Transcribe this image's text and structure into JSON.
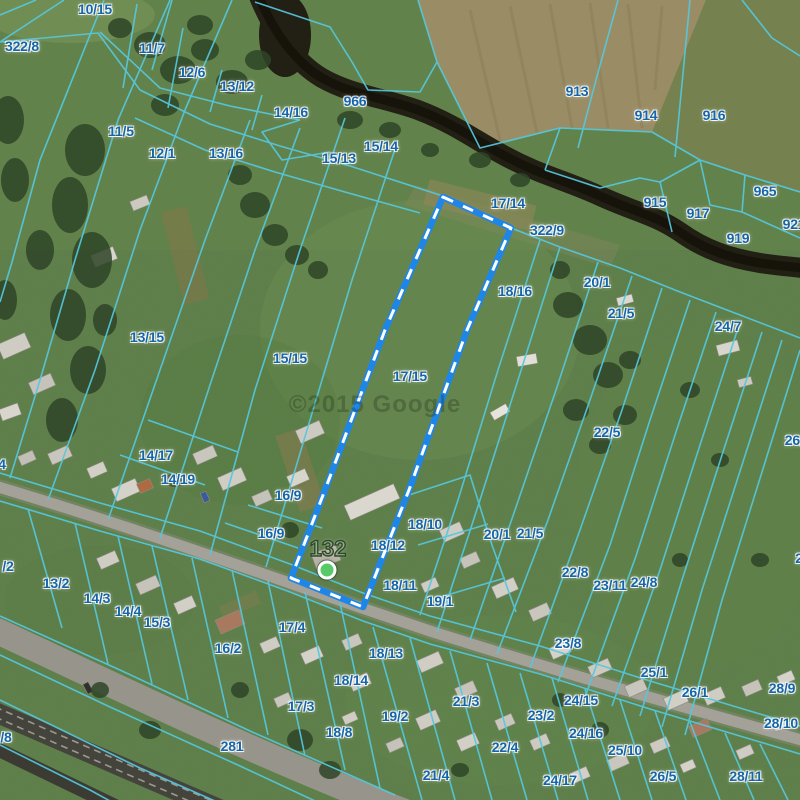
{
  "map": {
    "watermark": "©2015 Google",
    "selection": {
      "parcel_number": "17/15",
      "style": "blue-white-dashed"
    },
    "marker": {
      "label": "132",
      "x": 327,
      "y": 570
    },
    "colors": {
      "parcel_line": "#55c8de",
      "label_text": "#1565a8",
      "selection_stroke": "#1d86e8",
      "selection_dash": "#ffffff",
      "marker_fill": "#57c967",
      "marker_label": "#95aa8d"
    },
    "parcel_labels": [
      {
        "t": "10/15",
        "x": 95,
        "y": 9
      },
      {
        "t": "322/8",
        "x": 22,
        "y": 46
      },
      {
        "t": "11/7",
        "x": 152,
        "y": 48
      },
      {
        "t": "12/6",
        "x": 192,
        "y": 72
      },
      {
        "t": "13/12",
        "x": 237,
        "y": 86
      },
      {
        "t": "966",
        "x": 355,
        "y": 101
      },
      {
        "t": "14/16",
        "x": 291,
        "y": 112
      },
      {
        "t": "15/14",
        "x": 381,
        "y": 146
      },
      {
        "t": "15/13",
        "x": 339,
        "y": 158
      },
      {
        "t": "11/5",
        "x": 121,
        "y": 131
      },
      {
        "t": "12/1",
        "x": 162,
        "y": 153
      },
      {
        "t": "13/16",
        "x": 226,
        "y": 153
      },
      {
        "t": "913",
        "x": 577,
        "y": 91
      },
      {
        "t": "914",
        "x": 646,
        "y": 115
      },
      {
        "t": "916",
        "x": 714,
        "y": 115
      },
      {
        "t": "965",
        "x": 765,
        "y": 191
      },
      {
        "t": "915",
        "x": 655,
        "y": 202
      },
      {
        "t": "917",
        "x": 698,
        "y": 213
      },
      {
        "t": "919",
        "x": 738,
        "y": 238
      },
      {
        "t": "921",
        "x": 794,
        "y": 224
      },
      {
        "t": "17/14",
        "x": 508,
        "y": 203
      },
      {
        "t": "322/9",
        "x": 547,
        "y": 230
      },
      {
        "t": "18/16",
        "x": 515,
        "y": 291
      },
      {
        "t": "20/1",
        "x": 597,
        "y": 282
      },
      {
        "t": "21/5",
        "x": 621,
        "y": 313
      },
      {
        "t": "24/7",
        "x": 728,
        "y": 326
      },
      {
        "t": "22/5",
        "x": 607,
        "y": 432
      },
      {
        "t": "26/1",
        "x": 798,
        "y": 440
      },
      {
        "t": "13/15",
        "x": 147,
        "y": 337
      },
      {
        "t": "15/15",
        "x": 290,
        "y": 358
      },
      {
        "t": "17/15",
        "x": 410,
        "y": 376
      },
      {
        "t": "14/17",
        "x": 156,
        "y": 455
      },
      {
        "t": "14/19",
        "x": 178,
        "y": 479
      },
      {
        "t": "16/9",
        "x": 288,
        "y": 495
      },
      {
        "t": "16/9",
        "x": 271,
        "y": 533
      },
      {
        "t": "18/10",
        "x": 425,
        "y": 524
      },
      {
        "t": "18/12",
        "x": 388,
        "y": 545
      },
      {
        "t": "20/1",
        "x": 497,
        "y": 534
      },
      {
        "t": "21/5",
        "x": 530,
        "y": 533
      },
      {
        "t": "22/8",
        "x": 575,
        "y": 572
      },
      {
        "t": "23/11",
        "x": 610,
        "y": 585
      },
      {
        "t": "24/8",
        "x": 644,
        "y": 582
      },
      {
        "t": "18/11",
        "x": 400,
        "y": 585
      },
      {
        "t": "19/1",
        "x": 440,
        "y": 601
      },
      {
        "t": "2",
        "x": 799,
        "y": 558
      },
      {
        "t": "13/2",
        "x": 56,
        "y": 583
      },
      {
        "t": "/2",
        "x": 8,
        "y": 566
      },
      {
        "t": "4",
        "x": 2,
        "y": 464
      },
      {
        "t": "14/3",
        "x": 97,
        "y": 598
      },
      {
        "t": "14/4",
        "x": 128,
        "y": 611
      },
      {
        "t": "15/3",
        "x": 157,
        "y": 622
      },
      {
        "t": "16/2",
        "x": 228,
        "y": 648
      },
      {
        "t": "17/4",
        "x": 292,
        "y": 627
      },
      {
        "t": "18/13",
        "x": 386,
        "y": 653
      },
      {
        "t": "18/14",
        "x": 351,
        "y": 680
      },
      {
        "t": "17/3",
        "x": 301,
        "y": 706
      },
      {
        "t": "19/2",
        "x": 395,
        "y": 716
      },
      {
        "t": "18/8",
        "x": 339,
        "y": 732
      },
      {
        "t": "21/3",
        "x": 466,
        "y": 701
      },
      {
        "t": "21/4",
        "x": 436,
        "y": 775
      },
      {
        "t": "22/4",
        "x": 505,
        "y": 747
      },
      {
        "t": "23/2",
        "x": 541,
        "y": 715
      },
      {
        "t": "23/8",
        "x": 568,
        "y": 643
      },
      {
        "t": "24/15",
        "x": 581,
        "y": 700
      },
      {
        "t": "24/16",
        "x": 586,
        "y": 733
      },
      {
        "t": "25/10",
        "x": 625,
        "y": 750
      },
      {
        "t": "24/17",
        "x": 560,
        "y": 780
      },
      {
        "t": "25/1",
        "x": 654,
        "y": 672
      },
      {
        "t": "26/1",
        "x": 695,
        "y": 692
      },
      {
        "t": "26/5",
        "x": 663,
        "y": 776
      },
      {
        "t": "28/11",
        "x": 746,
        "y": 776
      },
      {
        "t": "28/9",
        "x": 782,
        "y": 688
      },
      {
        "t": "28/10",
        "x": 781,
        "y": 723
      },
      {
        "t": "281",
        "x": 232,
        "y": 746
      },
      {
        "t": "/8",
        "x": 6,
        "y": 737
      }
    ]
  }
}
